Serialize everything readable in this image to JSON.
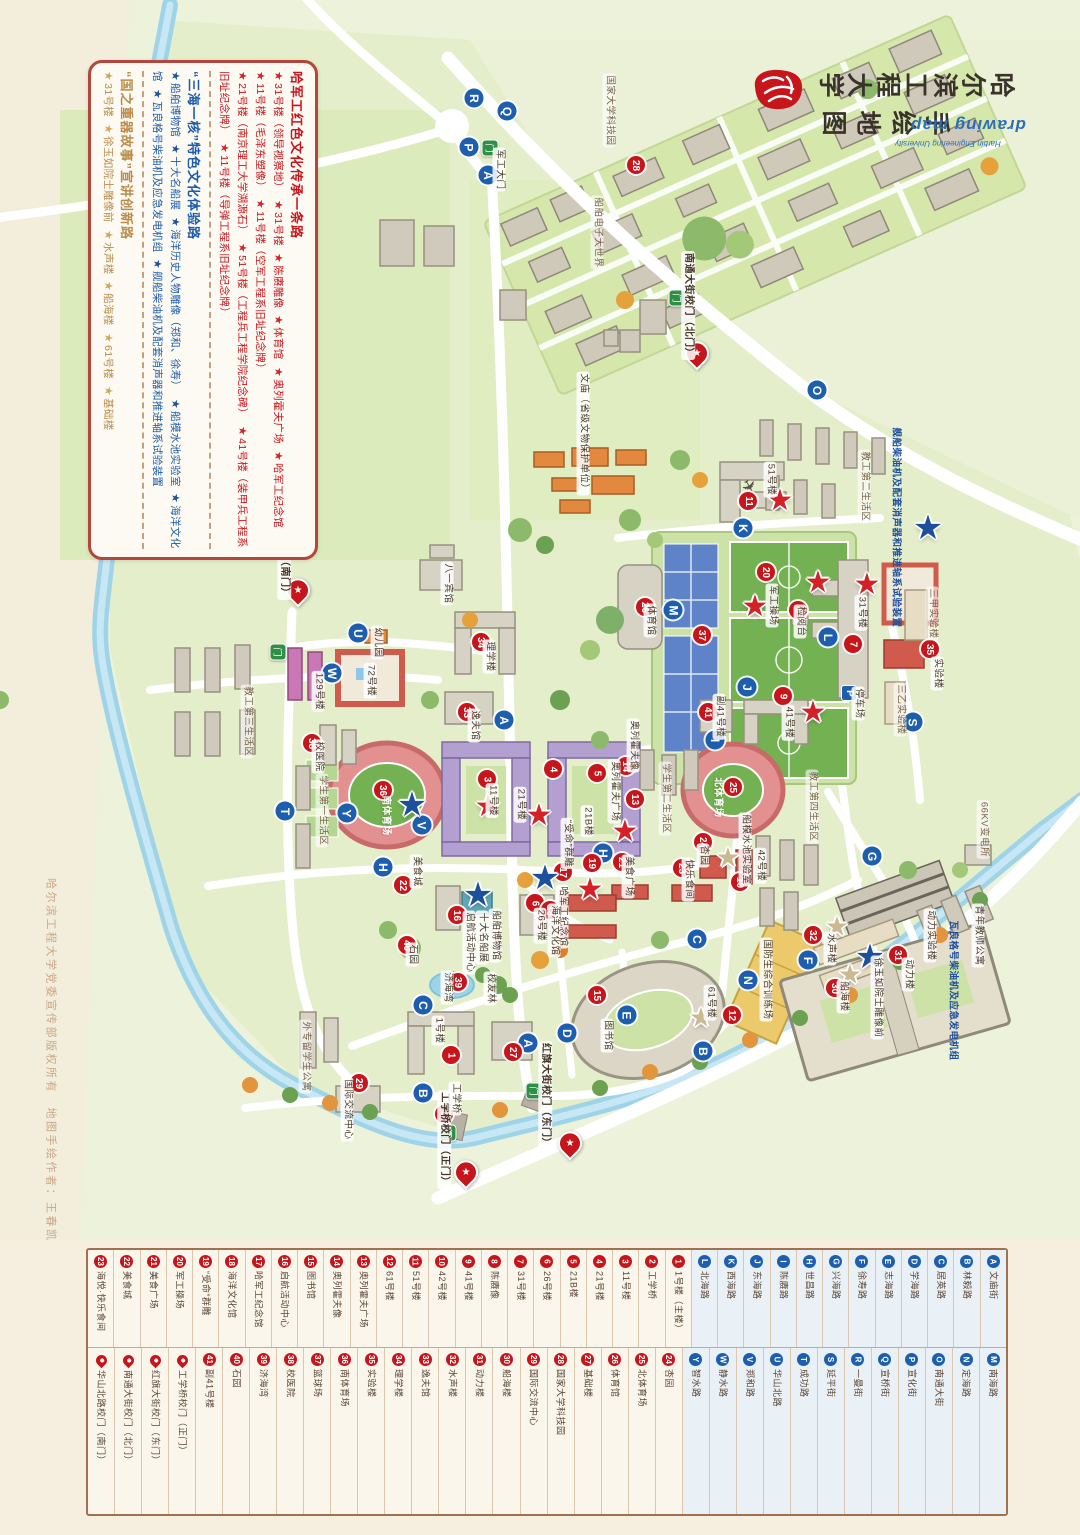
{
  "title": {
    "line1": "哈尔滨工程大学",
    "line2": "手绘地图",
    "script": "drawing map",
    "subtitle": "Harbin Engineering University"
  },
  "copyright": "哈尔滨工程大学党委宣传部版权所有　地图手绘作者：王春凯",
  "legend_box": {
    "sections": [
      {
        "title": "哈军工红色文化传承一条路",
        "color": "#c7151c",
        "star": "#d42127",
        "items": [
          "31号楼（领导视察地）",
          "31号楼",
          "陈赓雕像",
          "体育馆",
          "奥列霍夫广场",
          "哈军工纪念馆",
          "11号楼（毛泽东塑像）",
          "11号楼（空军工程系旧址纪念牌）",
          "21号楼（南京理工大学溯源石）",
          "51号楼（工程兵工程学院纪念碑）",
          "41号楼（装甲兵工程系旧址纪念牌）",
          "11号楼（导弹工程系旧址纪念牌）"
        ]
      },
      {
        "title": "“三海一核”特色文化体验路",
        "color": "#1c5ba8",
        "star": "#1c4f9c",
        "items": [
          "船舶博物馆",
          "十大名船展",
          "海洋历史人物雕像（郑和、徐寿）",
          "船模水池实验室",
          "海洋文化馆",
          "瓦良格号柴油机及应急发电机组",
          "舰船柴油机及配套消声器和推进轴系试验装置"
        ]
      },
      {
        "title": "“国之重器故事”宣讲创新路",
        "color": "#b98c4a",
        "star": "#cfa85a",
        "items": [
          "31号楼",
          "徐玉如院士雕像前",
          "水声楼",
          "船海楼",
          "61号楼",
          "基础楼"
        ]
      }
    ]
  },
  "map": {
    "letter_badges": [
      {
        "l": "A",
        "x": 488,
        "y": 175
      },
      {
        "l": "A",
        "x": 504,
        "y": 720
      },
      {
        "l": "A",
        "x": 528,
        "y": 1043
      },
      {
        "l": "B",
        "x": 423,
        "y": 1093
      },
      {
        "l": "B",
        "x": 703,
        "y": 1051
      },
      {
        "l": "C",
        "x": 423,
        "y": 1005
      },
      {
        "l": "C",
        "x": 697,
        "y": 939
      },
      {
        "l": "D",
        "x": 567,
        "y": 1033
      },
      {
        "l": "E",
        "x": 627,
        "y": 1015
      },
      {
        "l": "F",
        "x": 808,
        "y": 960
      },
      {
        "l": "G",
        "x": 872,
        "y": 856
      },
      {
        "l": "H",
        "x": 383,
        "y": 867
      },
      {
        "l": "H",
        "x": 603,
        "y": 853
      },
      {
        "l": "I",
        "x": 715,
        "y": 740
      },
      {
        "l": "J",
        "x": 747,
        "y": 687
      },
      {
        "l": "K",
        "x": 743,
        "y": 528
      },
      {
        "l": "L",
        "x": 828,
        "y": 637
      },
      {
        "l": "M",
        "x": 673,
        "y": 610
      },
      {
        "l": "N",
        "x": 748,
        "y": 980
      },
      {
        "l": "O",
        "x": 817,
        "y": 390
      },
      {
        "l": "P",
        "x": 469,
        "y": 147
      },
      {
        "l": "Q",
        "x": 507,
        "y": 111
      },
      {
        "l": "R",
        "x": 474,
        "y": 98
      },
      {
        "l": "S",
        "x": 913,
        "y": 722
      },
      {
        "l": "T",
        "x": 285,
        "y": 811
      },
      {
        "l": "U",
        "x": 358,
        "y": 633
      },
      {
        "l": "V",
        "x": 422,
        "y": 825
      },
      {
        "l": "W",
        "x": 332,
        "y": 673
      },
      {
        "l": "Y",
        "x": 347,
        "y": 813
      }
    ],
    "number_badges": [
      {
        "n": "1",
        "x": 451,
        "y": 1055
      },
      {
        "n": "2",
        "x": 444,
        "y": 1114
      },
      {
        "n": "3",
        "x": 487,
        "y": 779
      },
      {
        "n": "4",
        "x": 553,
        "y": 769
      },
      {
        "n": "5",
        "x": 597,
        "y": 773
      },
      {
        "n": "6",
        "x": 535,
        "y": 903
      },
      {
        "n": "7",
        "x": 853,
        "y": 644
      },
      {
        "n": "8",
        "x": 798,
        "y": 610
      },
      {
        "n": "9",
        "x": 783,
        "y": 696
      },
      {
        "n": "10",
        "x": 740,
        "y": 882
      },
      {
        "n": "11",
        "x": 748,
        "y": 501
      },
      {
        "n": "12",
        "x": 732,
        "y": 1015
      },
      {
        "n": "13",
        "x": 635,
        "y": 799
      },
      {
        "n": "14",
        "x": 626,
        "y": 766
      },
      {
        "n": "15",
        "x": 597,
        "y": 995
      },
      {
        "n": "16",
        "x": 457,
        "y": 915
      },
      {
        "n": "17",
        "x": 563,
        "y": 872
      },
      {
        "n": "18",
        "x": 550,
        "y": 910
      },
      {
        "n": "19",
        "x": 592,
        "y": 863
      },
      {
        "n": "20",
        "x": 766,
        "y": 572
      },
      {
        "n": "21",
        "x": 622,
        "y": 862
      },
      {
        "n": "22",
        "x": 403,
        "y": 885
      },
      {
        "n": "23",
        "x": 682,
        "y": 868
      },
      {
        "n": "24",
        "x": 703,
        "y": 842
      },
      {
        "n": "25",
        "x": 733,
        "y": 787
      },
      {
        "n": "26",
        "x": 645,
        "y": 607
      },
      {
        "n": "27",
        "x": 513,
        "y": 1052
      },
      {
        "n": "28",
        "x": 636,
        "y": 165
      },
      {
        "n": "29",
        "x": 359,
        "y": 1083
      },
      {
        "n": "30",
        "x": 835,
        "y": 988
      },
      {
        "n": "31",
        "x": 898,
        "y": 955
      },
      {
        "n": "32",
        "x": 813,
        "y": 935
      },
      {
        "n": "33",
        "x": 467,
        "y": 712
      },
      {
        "n": "34",
        "x": 481,
        "y": 642
      },
      {
        "n": "35",
        "x": 930,
        "y": 649
      },
      {
        "n": "36",
        "x": 383,
        "y": 790
      },
      {
        "n": "37",
        "x": 702,
        "y": 635
      },
      {
        "n": "38",
        "x": 312,
        "y": 743
      },
      {
        "n": "39",
        "x": 458,
        "y": 982
      },
      {
        "n": "40",
        "x": 407,
        "y": 945
      },
      {
        "n": "41",
        "x": 708,
        "y": 712
      }
    ],
    "stars": [
      {
        "c": "red",
        "x": 780,
        "y": 501
      },
      {
        "c": "red",
        "x": 755,
        "y": 607
      },
      {
        "c": "red",
        "x": 818,
        "y": 583
      },
      {
        "c": "red",
        "x": 867,
        "y": 585
      },
      {
        "c": "red",
        "x": 625,
        "y": 832
      },
      {
        "c": "red",
        "x": 539,
        "y": 816
      },
      {
        "c": "red",
        "x": 488,
        "y": 807
      },
      {
        "c": "red",
        "x": 590,
        "y": 890
      },
      {
        "c": "red",
        "x": 813,
        "y": 713
      },
      {
        "c": "blue",
        "x": 928,
        "y": 528
      },
      {
        "c": "blue",
        "x": 412,
        "y": 805
      },
      {
        "c": "blue",
        "x": 545,
        "y": 878
      },
      {
        "c": "blue",
        "x": 478,
        "y": 895
      },
      {
        "c": "blue",
        "x": 870,
        "y": 957
      },
      {
        "c": "tan",
        "x": 728,
        "y": 858
      },
      {
        "c": "tan",
        "x": 837,
        "y": 927
      },
      {
        "c": "tan",
        "x": 850,
        "y": 975
      },
      {
        "c": "tan",
        "x": 701,
        "y": 1018
      }
    ],
    "gates": [
      {
        "label": "南通大街校门（北门）",
        "px": 697,
        "py": 363,
        "lx": 688,
        "ly": 308
      },
      {
        "label": "华山北路校门（南门）",
        "px": 298,
        "py": 600,
        "lx": 284,
        "ly": 548
      },
      {
        "label": "红旗大街校门（东门）",
        "px": 570,
        "py": 1153,
        "lx": 545,
        "ly": 1098
      },
      {
        "label": "工学桥校门（正门）",
        "px": 466,
        "py": 1182,
        "lx": 444,
        "ly": 1142
      }
    ],
    "green_gates": [
      {
        "x": 490,
        "y": 148
      },
      {
        "x": 677,
        "y": 298
      },
      {
        "x": 278,
        "y": 652
      },
      {
        "x": 448,
        "y": 1133
      },
      {
        "x": 534,
        "y": 1091
      }
    ],
    "parking": [
      {
        "x": 849,
        "y": 693
      }
    ],
    "labels": [
      {
        "t": "国家大学科技园",
        "x": 609,
        "y": 113,
        "s": "area"
      },
      {
        "t": "船舶电子大世界",
        "x": 597,
        "y": 235,
        "s": "area"
      },
      {
        "t": "军工大门",
        "x": 499,
        "y": 172
      },
      {
        "t": "文庙（省级文物保护单位）",
        "x": 583,
        "y": 436
      },
      {
        "t": "八一宾馆",
        "x": 447,
        "y": 586
      },
      {
        "t": "教工第二生活区",
        "x": 864,
        "y": 489,
        "s": "area"
      },
      {
        "t": "51号楼",
        "x": 770,
        "y": 482
      },
      {
        "t": "体育馆",
        "x": 650,
        "y": 623
      },
      {
        "t": "军工操场",
        "x": 772,
        "y": 608
      },
      {
        "t": "检阅台",
        "x": 800,
        "y": 624
      },
      {
        "t": "31号楼",
        "x": 861,
        "y": 615
      },
      {
        "t": "三甲实验楼",
        "x": 932,
        "y": 616,
        "s": "area"
      },
      {
        "t": "三乙实验楼",
        "x": 900,
        "y": 712,
        "s": "area"
      },
      {
        "t": "实验楼",
        "x": 937,
        "y": 676
      },
      {
        "t": "幼儿园",
        "x": 377,
        "y": 645
      },
      {
        "t": "72号楼",
        "x": 370,
        "y": 683
      },
      {
        "t": "129号楼",
        "x": 318,
        "y": 694
      },
      {
        "t": "教工第三生活区",
        "x": 247,
        "y": 724,
        "s": "area"
      },
      {
        "t": "校医院",
        "x": 318,
        "y": 759
      },
      {
        "t": "理学楼",
        "x": 489,
        "y": 659
      },
      {
        "t": "逸夫馆",
        "x": 474,
        "y": 728
      },
      {
        "t": "学生第一生活区",
        "x": 322,
        "y": 813,
        "s": "area"
      },
      {
        "t": "南体育场",
        "x": 385,
        "y": 818,
        "s": "field"
      },
      {
        "t": "11号楼",
        "x": 492,
        "y": 803
      },
      {
        "t": "21号楼",
        "x": 520,
        "y": 807
      },
      {
        "t": "21B楼",
        "x": 587,
        "y": 824
      },
      {
        "t": "奥列霍夫广场",
        "x": 614,
        "y": 794
      },
      {
        "t": "奥列霍夫像",
        "x": 633,
        "y": 748
      },
      {
        "t": "学生第二生活区",
        "x": 665,
        "y": 801,
        "s": "area"
      },
      {
        "t": "副41号楼",
        "x": 719,
        "y": 719
      },
      {
        "t": "41号楼",
        "x": 788,
        "y": 725
      },
      {
        "t": "停车场",
        "x": 858,
        "y": 706
      },
      {
        "t": "“受命”群雕",
        "x": 567,
        "y": 846
      },
      {
        "t": "美食城",
        "x": 416,
        "y": 874
      },
      {
        "t": "美食广场",
        "x": 628,
        "y": 879
      },
      {
        "t": "快乐食间",
        "x": 688,
        "y": 882
      },
      {
        "t": "哈军工纪念馆",
        "x": 562,
        "y": 919
      },
      {
        "t": "26号楼",
        "x": 540,
        "y": 928
      },
      {
        "t": "海洋文化馆",
        "x": 554,
        "y": 933
      },
      {
        "t": "船舶博物馆",
        "x": 495,
        "y": 938
      },
      {
        "t": "十大名船展",
        "x": 482,
        "y": 940
      },
      {
        "t": "启航活动中心",
        "x": 469,
        "y": 945
      },
      {
        "t": "石园",
        "x": 412,
        "y": 957
      },
      {
        "t": "济海湾",
        "x": 447,
        "y": 990
      },
      {
        "t": "校友林",
        "x": 490,
        "y": 991
      },
      {
        "t": "北体育场",
        "x": 717,
        "y": 800,
        "s": "field"
      },
      {
        "t": "杏园",
        "x": 703,
        "y": 858
      },
      {
        "t": "42号楼",
        "x": 760,
        "y": 868
      },
      {
        "t": "教工第四生活区",
        "x": 812,
        "y": 809,
        "s": "area"
      },
      {
        "t": "船模水池实验室",
        "x": 745,
        "y": 852
      },
      {
        "t": "66KV变电所",
        "x": 983,
        "y": 832,
        "s": "area"
      },
      {
        "t": "青年教师公寓",
        "x": 978,
        "y": 938
      },
      {
        "t": "动力实验楼",
        "x": 930,
        "y": 938
      },
      {
        "t": "动力楼",
        "x": 908,
        "y": 977
      },
      {
        "t": "水声楼",
        "x": 830,
        "y": 951
      },
      {
        "t": "船海楼",
        "x": 843,
        "y": 999
      },
      {
        "t": "徐玉如院士雕像前",
        "x": 877,
        "y": 1000
      },
      {
        "t": "瓦良格号柴油机及应急发电机组",
        "x": 952,
        "y": 993,
        "s": "blue"
      },
      {
        "t": "舰船柴油机及配套消声器和推进轴系试验装置",
        "x": 895,
        "y": 530,
        "s": "blue"
      },
      {
        "t": "国防生综合训练场",
        "x": 766,
        "y": 982
      },
      {
        "t": "61号楼",
        "x": 710,
        "y": 1005
      },
      {
        "t": "图书馆",
        "x": 607,
        "y": 1038
      },
      {
        "t": "1号楼",
        "x": 438,
        "y": 1033
      },
      {
        "t": "外专留学生公寓",
        "x": 305,
        "y": 1059,
        "s": "area"
      },
      {
        "t": "国际交流中心",
        "x": 347,
        "y": 1112
      },
      {
        "t": "工学桥",
        "x": 455,
        "y": 1101
      }
    ]
  },
  "bottom_legend": {
    "row1": [
      {
        "b": "23",
        "t": "num",
        "l": "海悦·快乐食间"
      },
      {
        "b": "22",
        "t": "num",
        "l": "美食城"
      },
      {
        "b": "21",
        "t": "num",
        "l": "美食广场"
      },
      {
        "b": "20",
        "t": "num",
        "l": "军工操场"
      },
      {
        "b": "19",
        "t": "num",
        "l": "“受命”群雕"
      },
      {
        "b": "18",
        "t": "num",
        "l": "海洋文化馆"
      },
      {
        "b": "17",
        "t": "num",
        "l": "哈军工纪念馆"
      },
      {
        "b": "16",
        "t": "num",
        "l": "启航活动中心"
      },
      {
        "b": "15",
        "t": "num",
        "l": "图书馆"
      },
      {
        "b": "14",
        "t": "num",
        "l": "奥列霍夫像"
      },
      {
        "b": "13",
        "t": "num",
        "l": "奥列霍夫广场"
      },
      {
        "b": "12",
        "t": "num",
        "l": "61号楼"
      },
      {
        "b": "11",
        "t": "num",
        "l": "51号楼"
      },
      {
        "b": "10",
        "t": "num",
        "l": "42号楼"
      },
      {
        "b": "9",
        "t": "num",
        "l": "41号楼"
      },
      {
        "b": "8",
        "t": "num",
        "l": "陈赓像"
      },
      {
        "b": "7",
        "t": "num",
        "l": "31号楼"
      },
      {
        "b": "6",
        "t": "num",
        "l": "26号楼"
      },
      {
        "b": "5",
        "t": "num",
        "l": "21B楼"
      },
      {
        "b": "4",
        "t": "num",
        "l": "21号楼"
      },
      {
        "b": "3",
        "t": "num",
        "l": "11号楼"
      },
      {
        "b": "2",
        "t": "num",
        "l": "工学桥"
      },
      {
        "b": "1",
        "t": "num",
        "l": "1号楼（主楼）"
      },
      {
        "b": "L",
        "t": "road",
        "l": "北海路"
      },
      {
        "b": "K",
        "t": "road",
        "l": "西海路"
      },
      {
        "b": "J",
        "t": "road",
        "l": "东海路"
      },
      {
        "b": "I",
        "t": "road",
        "l": "陈赓路"
      },
      {
        "b": "H",
        "t": "road",
        "l": "世昌路"
      },
      {
        "b": "G",
        "t": "road",
        "l": "兴海路"
      },
      {
        "b": "F",
        "t": "road",
        "l": "徐寿路"
      },
      {
        "b": "E",
        "t": "road",
        "l": "志海路"
      },
      {
        "b": "D",
        "t": "road",
        "l": "学海路"
      },
      {
        "b": "C",
        "t": "road",
        "l": "居英路"
      },
      {
        "b": "B",
        "t": "road",
        "l": "林毅路"
      },
      {
        "b": "A",
        "t": "road",
        "l": "文庙街"
      }
    ],
    "row2": [
      {
        "b": "",
        "t": "gate",
        "l": "华山北路校门（南门）"
      },
      {
        "b": "",
        "t": "gate",
        "l": "南通大街校门（北门）"
      },
      {
        "b": "",
        "t": "gate",
        "l": "红旗大街校门（东门）"
      },
      {
        "b": "",
        "t": "gate",
        "l": "工学桥校门（正门）"
      },
      {
        "b": "41",
        "t": "num",
        "l": "副41号楼"
      },
      {
        "b": "40",
        "t": "num",
        "l": "石园"
      },
      {
        "b": "39",
        "t": "num",
        "l": "济海湾"
      },
      {
        "b": "38",
        "t": "num",
        "l": "校医院"
      },
      {
        "b": "37",
        "t": "num",
        "l": "篮球场"
      },
      {
        "b": "36",
        "t": "num",
        "l": "南体育场"
      },
      {
        "b": "35",
        "t": "num",
        "l": "实验楼"
      },
      {
        "b": "34",
        "t": "num",
        "l": "理学楼"
      },
      {
        "b": "33",
        "t": "num",
        "l": "逸夫馆"
      },
      {
        "b": "32",
        "t": "num",
        "l": "水声楼"
      },
      {
        "b": "31",
        "t": "num",
        "l": "动力楼"
      },
      {
        "b": "30",
        "t": "num",
        "l": "船海楼"
      },
      {
        "b": "29",
        "t": "num",
        "l": "国际交流中心"
      },
      {
        "b": "28",
        "t": "num",
        "l": "国家大学科技园"
      },
      {
        "b": "27",
        "t": "num",
        "l": "基础楼"
      },
      {
        "b": "26",
        "t": "num",
        "l": "体育馆"
      },
      {
        "b": "25",
        "t": "num",
        "l": "北体育场"
      },
      {
        "b": "24",
        "t": "num",
        "l": "杏园"
      },
      {
        "b": "Y",
        "t": "road",
        "l": "智水路"
      },
      {
        "b": "W",
        "t": "road",
        "l": "静水路"
      },
      {
        "b": "V",
        "t": "road",
        "l": "郑和路"
      },
      {
        "b": "U",
        "t": "road",
        "l": "华山北路"
      },
      {
        "b": "T",
        "t": "road",
        "l": "成功路"
      },
      {
        "b": "S",
        "t": "road",
        "l": "延平街"
      },
      {
        "b": "R",
        "t": "road",
        "l": "一曼街"
      },
      {
        "b": "Q",
        "t": "road",
        "l": "宣桥街"
      },
      {
        "b": "P",
        "t": "road",
        "l": "宣化街"
      },
      {
        "b": "O",
        "t": "road",
        "l": "南通大街"
      },
      {
        "b": "N",
        "t": "road",
        "l": "定海路"
      },
      {
        "b": "M",
        "t": "road",
        "l": "南海路"
      }
    ]
  }
}
